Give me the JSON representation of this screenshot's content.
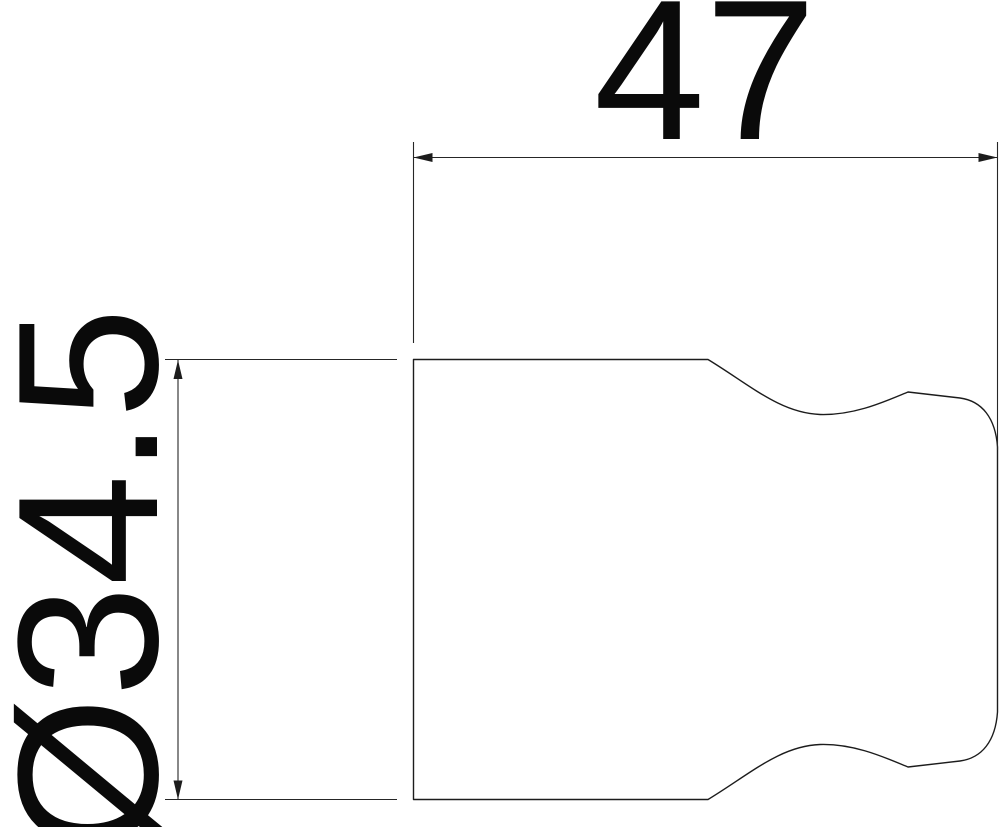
{
  "drawing": {
    "dimension_labels": {
      "width": "47",
      "diameter": "Ø34.5"
    },
    "colors": {
      "background": "#ffffff",
      "outline": "#1c1c1c",
      "dimension_line": "#262626",
      "text": "#0a0a0a"
    }
  }
}
